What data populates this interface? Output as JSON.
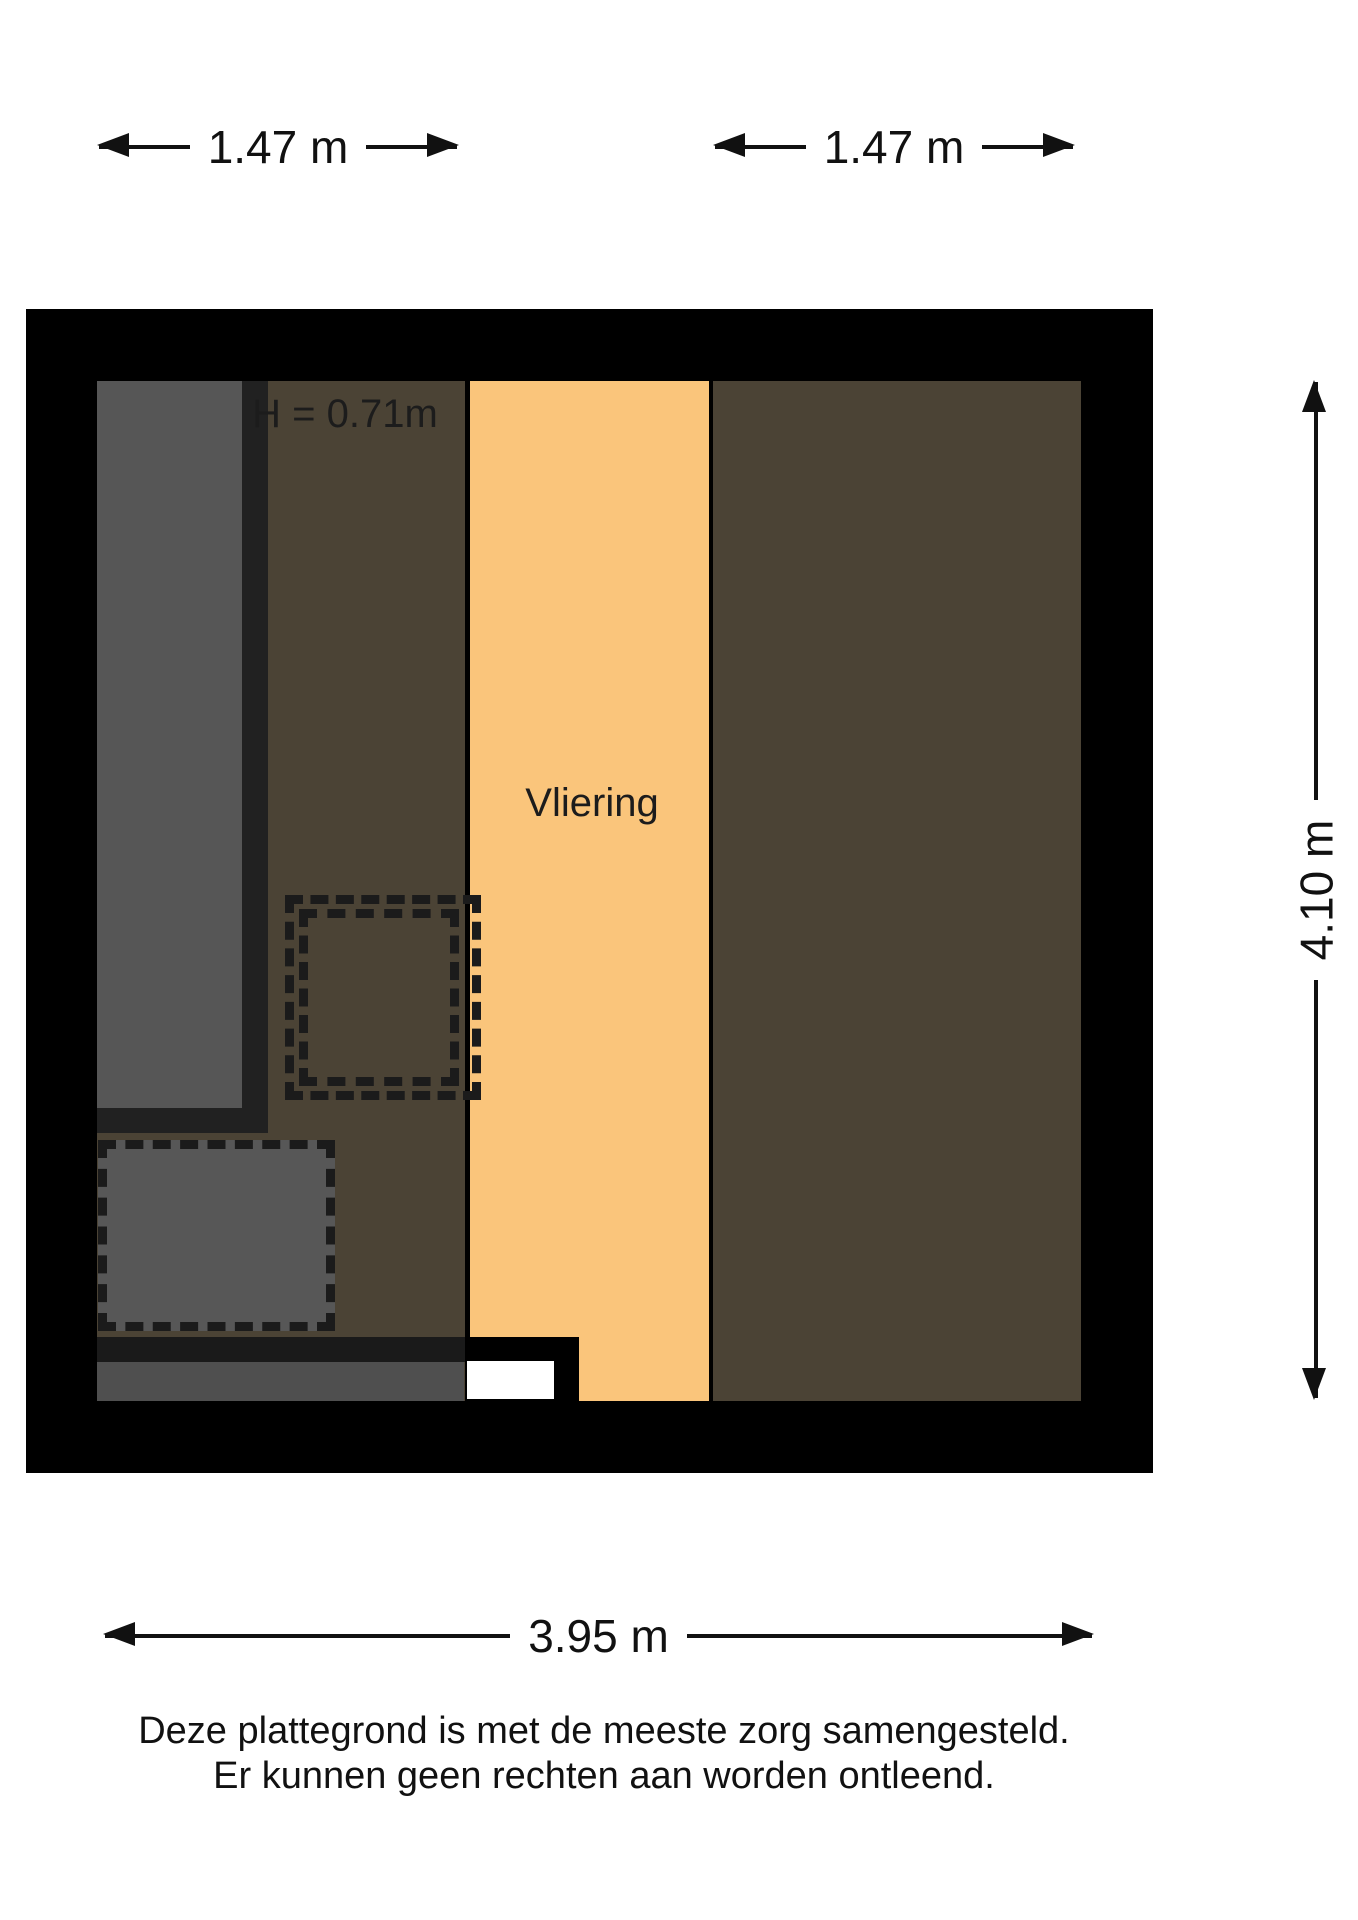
{
  "dimensions": {
    "top_left": "1.47 m",
    "top_right": "1.47 m",
    "right_side": "4.10 m",
    "bottom": "3.95 m"
  },
  "labels": {
    "room": "Vliering",
    "ceiling_height": "H = 0.71m"
  },
  "disclaimer": {
    "line1": "Deze plattegrond is met de meeste zorg samengesteld.",
    "line2": "Er kunnen geen rechten aan worden ontleend."
  },
  "colors": {
    "wall": "#000000",
    "room_fill": "#fac57b",
    "sloped_attic_fill": "#4b4335",
    "void_fill": "#565656",
    "void_border": "#212121",
    "stair_fill": "#575757",
    "lower_band_fill": "#4f4f4f",
    "dash": "#1b1b1b"
  }
}
